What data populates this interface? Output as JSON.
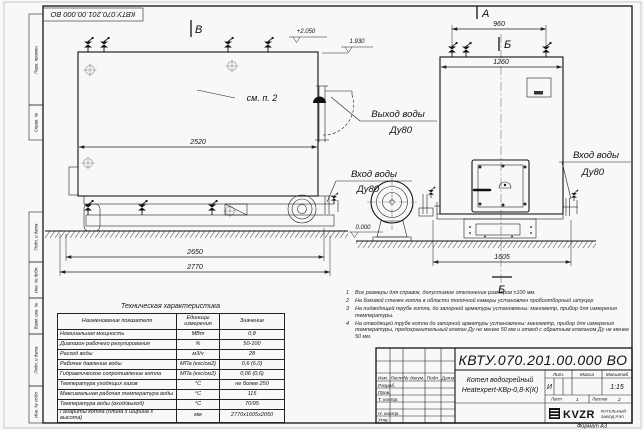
{
  "sheet": {
    "code_mirrored": "КВТУ.070.201.00.000  ВО",
    "format_note": "Формат  А3",
    "margin_labels": [
      "Перв. примен.",
      "Справ. №",
      "Подп. и дата",
      "Инв. № дубл.",
      "Взам. инв. №",
      "Подп. и дата",
      "Инв. № подл."
    ]
  },
  "drawing": {
    "views": {
      "b": "В",
      "a": "А",
      "section": "Б"
    },
    "callouts": {
      "see_item": "см. п. 2",
      "outlet": "Выход воды",
      "inlet": "Вход воды",
      "dn": "Ду80"
    },
    "elevations": {
      "top": "+2.050",
      "mid": "1.930",
      "zero": "0.000"
    },
    "dims": {
      "d2520": "2520",
      "d2650": "2650",
      "d2770": "2770",
      "d960": "960",
      "d1260": "1260",
      "d1605": "1605"
    }
  },
  "tech_table": {
    "title": "Техническая характеристика",
    "headers": [
      "Наименование показателя",
      "Единицы измерения",
      "Значение"
    ],
    "rows": [
      [
        "Номинальная мощность",
        "МВт",
        "0,8"
      ],
      [
        "Диапазон рабочего регулирования",
        "%",
        "50-100"
      ],
      [
        "Расход воды",
        "м3/ч",
        "28"
      ],
      [
        "Рабочее давление воды",
        "МПа (кгс/см2)",
        "0,6 (6,0)"
      ],
      [
        "Гидравлическое сопротивление котла",
        "МПа (кгс/см2)",
        "0,06 (0,6)"
      ],
      [
        "Температура уходящих газов",
        "°С",
        "не более 250"
      ],
      [
        "Максимальная рабочая температура воды",
        "°С",
        "115"
      ],
      [
        "Температура воды (вход/выход)",
        "°С",
        "70/95"
      ],
      [
        "Габариты котла (длина х ширина х высота)",
        "мм",
        "2770х1605х2050"
      ]
    ]
  },
  "notes": [
    {
      "n": "1",
      "text": "Все размеры для справок, допустимое отклонение размеров ±100 мм."
    },
    {
      "n": "2",
      "text": "На боковой стенке котла в области топочной камеры установлен пробоотборный штуцер"
    },
    {
      "n": "3",
      "text": "На подводящей трубе котла, до запорной арматуры установлены: манометр, прибор для измерения температуры."
    },
    {
      "n": "4",
      "text": "На отводящей трубе котла до запорной арматуры установлены: манометр, прибор для измерения температуры, предохранительный клапан Ду не менее 50 мм и отвод с обратным клапаном Ду не менее 50 мм."
    }
  ],
  "title_block": {
    "doc_number": "КВТУ.070.201.00.000  ВО",
    "product_line1": "Котел водогрейный",
    "product_line2": "Heatexpert-КВр-0,8-К(К)",
    "cols": {
      "izm": "Изм.",
      "list": "Лист",
      "doc": "№ докум.",
      "sign": "Подп.",
      "date": "Дата"
    },
    "rows": [
      "Разраб.",
      "Пров.",
      "Т. контр.",
      "",
      "Н. контр.",
      "Утв."
    ],
    "lit": {
      "label": "Лит.",
      "value": "И"
    },
    "mass": {
      "label": "Масса",
      "value": ""
    },
    "scale": {
      "label": "Масштаб",
      "value": "1:15"
    },
    "sheet": {
      "label": "Лист",
      "value": "1"
    },
    "sheets": {
      "label": "Листов",
      "value": "2"
    },
    "company": {
      "logo": "KVZR",
      "line1": "КОТЕЛЬНЫЙ",
      "line2": "ЗАВОД РЭП"
    }
  }
}
